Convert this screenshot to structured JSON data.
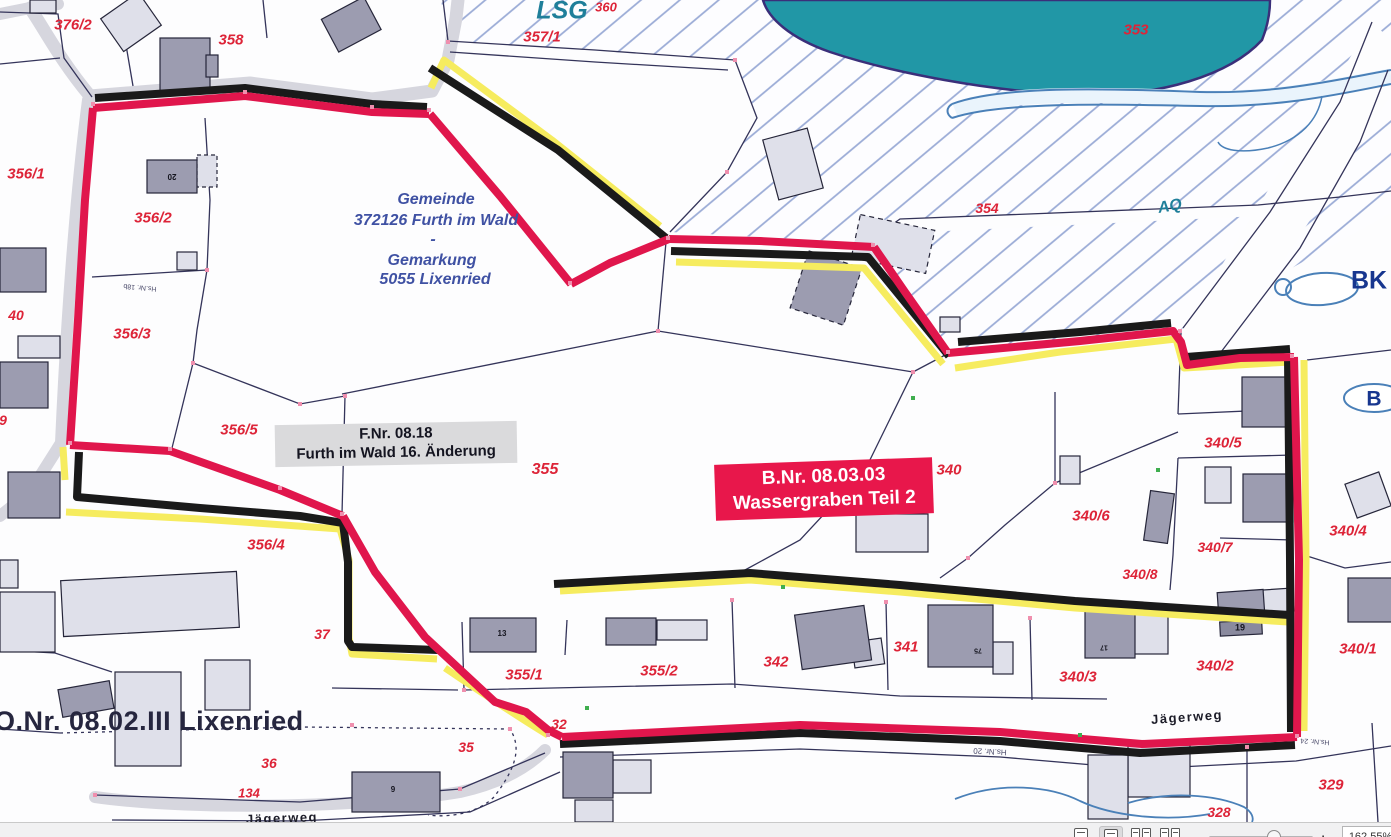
{
  "toolbar": {
    "zoom_out_label": "−",
    "zoom_in_label": "+",
    "zoom_level": "162,55%"
  },
  "map": {
    "fnr_box": {
      "line1": "F.Nr. 08.18",
      "line2": "Furth im Wald 16. Änderung"
    },
    "bnr_box": {
      "line1": "B.Nr. 08.03.03",
      "line2": "Wassergraben Teil 2"
    },
    "labels": [
      {
        "name": "parcel-376-2",
        "text": "376/2",
        "x": 73,
        "y": 25,
        "size": 15,
        "cls": "red"
      },
      {
        "name": "parcel-358",
        "text": "358",
        "x": 231,
        "y": 40,
        "size": 15,
        "cls": "red"
      },
      {
        "name": "parcel-357-1",
        "text": "357/1",
        "x": 542,
        "y": 37,
        "size": 15,
        "cls": "red"
      },
      {
        "name": "parcel-360",
        "text": "360",
        "x": 606,
        "y": 7,
        "size": 13,
        "cls": "red"
      },
      {
        "name": "parcel-353",
        "text": "353",
        "x": 1136,
        "y": 30,
        "size": 15,
        "cls": "red"
      },
      {
        "name": "parcel-354",
        "text": "354",
        "x": 987,
        "y": 208,
        "size": 14,
        "cls": "red"
      },
      {
        "name": "parcel-356-1",
        "text": "356/1",
        "x": 26,
        "y": 174,
        "size": 15,
        "cls": "red"
      },
      {
        "name": "parcel-356-2",
        "text": "356/2",
        "x": 153,
        "y": 218,
        "size": 15,
        "cls": "red"
      },
      {
        "name": "parcel-356-3",
        "text": "356/3",
        "x": 132,
        "y": 334,
        "size": 15,
        "cls": "red"
      },
      {
        "name": "parcel-356-5",
        "text": "356/5",
        "x": 239,
        "y": 430,
        "size": 15,
        "cls": "red"
      },
      {
        "name": "parcel-356-4",
        "text": "356/4",
        "x": 266,
        "y": 545,
        "size": 15,
        "cls": "red"
      },
      {
        "name": "parcel-40",
        "text": "40",
        "x": 16,
        "y": 315,
        "size": 14,
        "cls": "red"
      },
      {
        "name": "parcel-9",
        "text": "9",
        "x": 3,
        "y": 420,
        "size": 14,
        "cls": "red"
      },
      {
        "name": "parcel-355",
        "text": "355",
        "x": 545,
        "y": 470,
        "size": 16,
        "cls": "red"
      },
      {
        "name": "parcel-340",
        "text": "340",
        "x": 949,
        "y": 470,
        "size": 15,
        "cls": "red"
      },
      {
        "name": "parcel-340-5",
        "text": "340/5",
        "x": 1223,
        "y": 443,
        "size": 15,
        "cls": "red"
      },
      {
        "name": "parcel-340-6",
        "text": "340/6",
        "x": 1091,
        "y": 516,
        "size": 15,
        "cls": "red"
      },
      {
        "name": "parcel-340-7",
        "text": "340/7",
        "x": 1215,
        "y": 547,
        "size": 14,
        "cls": "red"
      },
      {
        "name": "parcel-340-4",
        "text": "340/4",
        "x": 1348,
        "y": 531,
        "size": 15,
        "cls": "red"
      },
      {
        "name": "parcel-340-8",
        "text": "340/8",
        "x": 1140,
        "y": 574,
        "size": 14,
        "cls": "red"
      },
      {
        "name": "parcel-340-2",
        "text": "340/2",
        "x": 1215,
        "y": 666,
        "size": 15,
        "cls": "red"
      },
      {
        "name": "parcel-340-1",
        "text": "340/1",
        "x": 1358,
        "y": 649,
        "size": 15,
        "cls": "red"
      },
      {
        "name": "parcel-340-3",
        "text": "340/3",
        "x": 1078,
        "y": 677,
        "size": 15,
        "cls": "red"
      },
      {
        "name": "parcel-341",
        "text": "341",
        "x": 906,
        "y": 647,
        "size": 15,
        "cls": "red"
      },
      {
        "name": "parcel-342",
        "text": "342",
        "x": 776,
        "y": 662,
        "size": 15,
        "cls": "red"
      },
      {
        "name": "parcel-355-1",
        "text": "355/1",
        "x": 524,
        "y": 675,
        "size": 15,
        "cls": "red"
      },
      {
        "name": "parcel-355-2",
        "text": "355/2",
        "x": 659,
        "y": 671,
        "size": 15,
        "cls": "red"
      },
      {
        "name": "parcel-37",
        "text": "37",
        "x": 322,
        "y": 634,
        "size": 14,
        "cls": "red"
      },
      {
        "name": "parcel-32",
        "text": "32",
        "x": 559,
        "y": 724,
        "size": 14,
        "cls": "red"
      },
      {
        "name": "parcel-35",
        "text": "35",
        "x": 466,
        "y": 747,
        "size": 14,
        "cls": "red"
      },
      {
        "name": "parcel-36",
        "text": "36",
        "x": 269,
        "y": 763,
        "size": 14,
        "cls": "red"
      },
      {
        "name": "parcel-134",
        "text": "134",
        "x": 249,
        "y": 793,
        "size": 13,
        "cls": "red"
      },
      {
        "name": "parcel-329",
        "text": "329",
        "x": 1331,
        "y": 785,
        "size": 15,
        "cls": "red"
      },
      {
        "name": "parcel-328",
        "text": "328",
        "x": 1219,
        "y": 812,
        "size": 14,
        "cls": "red"
      },
      {
        "name": "label-lsg",
        "text": "LSG",
        "x": 562,
        "y": 11,
        "size": 25,
        "cls": "teal"
      },
      {
        "name": "label-aq",
        "text": "AQ",
        "x": 1170,
        "y": 207,
        "size": 16,
        "cls": "teal",
        "rot": -10
      },
      {
        "name": "label-bk",
        "text": "BK",
        "x": 1369,
        "y": 281,
        "size": 25,
        "cls": "navy"
      },
      {
        "name": "label-b",
        "text": "B",
        "x": 1374,
        "y": 399,
        "size": 21,
        "cls": "navy"
      },
      {
        "name": "gemeinde-line1",
        "text": "Gemeinde",
        "x": 436,
        "y": 200,
        "size": 16,
        "cls": "blue"
      },
      {
        "name": "gemeinde-line2",
        "text": "372126 Furth im Wald",
        "x": 436,
        "y": 221,
        "size": 16,
        "cls": "blue"
      },
      {
        "name": "gemeinde-line3",
        "text": "-",
        "x": 433,
        "y": 240,
        "size": 16,
        "cls": "blue"
      },
      {
        "name": "gemeinde-line4",
        "text": "Gemarkung",
        "x": 432,
        "y": 261,
        "size": 16,
        "cls": "blue"
      },
      {
        "name": "gemeinde-line5",
        "text": "5055 Lixenried",
        "x": 435,
        "y": 280,
        "size": 16,
        "cls": "blue"
      },
      {
        "name": "label-onr",
        "text": "O.Nr. 08.02.III Lixenried",
        "x": -6,
        "y": 708,
        "size": 27,
        "cls": "dark",
        "anchor": "left"
      },
      {
        "name": "street-jaegerweg-left",
        "text": "Jägerweg",
        "x": 282,
        "y": 818,
        "size": 13,
        "cls": "roadname",
        "rot": -2
      },
      {
        "name": "street-jaegerweg-right",
        "text": "Jägerweg",
        "x": 1187,
        "y": 717,
        "size": 13,
        "cls": "roadname",
        "rot": -4
      },
      {
        "name": "hsnr-18b",
        "text": "Hs.Nr. 18b",
        "x": 140,
        "y": 287,
        "size": 7,
        "cls": "tiny",
        "rot": 185
      },
      {
        "name": "hsnr-20",
        "text": "Hs.Nr. 20",
        "x": 990,
        "y": 751,
        "size": 8,
        "cls": "tiny",
        "rot": 183
      },
      {
        "name": "hsnr-24",
        "text": "Hs.Nr. 24",
        "x": 1315,
        "y": 741,
        "size": 7,
        "cls": "tiny",
        "rot": 184
      },
      {
        "name": "housenum-13",
        "text": "13",
        "x": 502,
        "y": 634,
        "size": 8,
        "cls": "bnum"
      },
      {
        "name": "housenum-9",
        "text": "9",
        "x": 393,
        "y": 790,
        "size": 8,
        "cls": "bnum"
      },
      {
        "name": "housenum-19",
        "text": "19",
        "x": 1240,
        "y": 628,
        "size": 9,
        "cls": "bnum"
      },
      {
        "name": "housenum-20",
        "text": "20",
        "x": 172,
        "y": 176,
        "size": 8,
        "cls": "bnum",
        "rot": 180
      },
      {
        "name": "housenum-75",
        "text": "75",
        "x": 978,
        "y": 650,
        "size": 7,
        "cls": "bnum",
        "rot": 180
      },
      {
        "name": "housenum-17",
        "text": "17",
        "x": 1104,
        "y": 647,
        "size": 7,
        "cls": "bnum",
        "rot": 180
      }
    ]
  }
}
